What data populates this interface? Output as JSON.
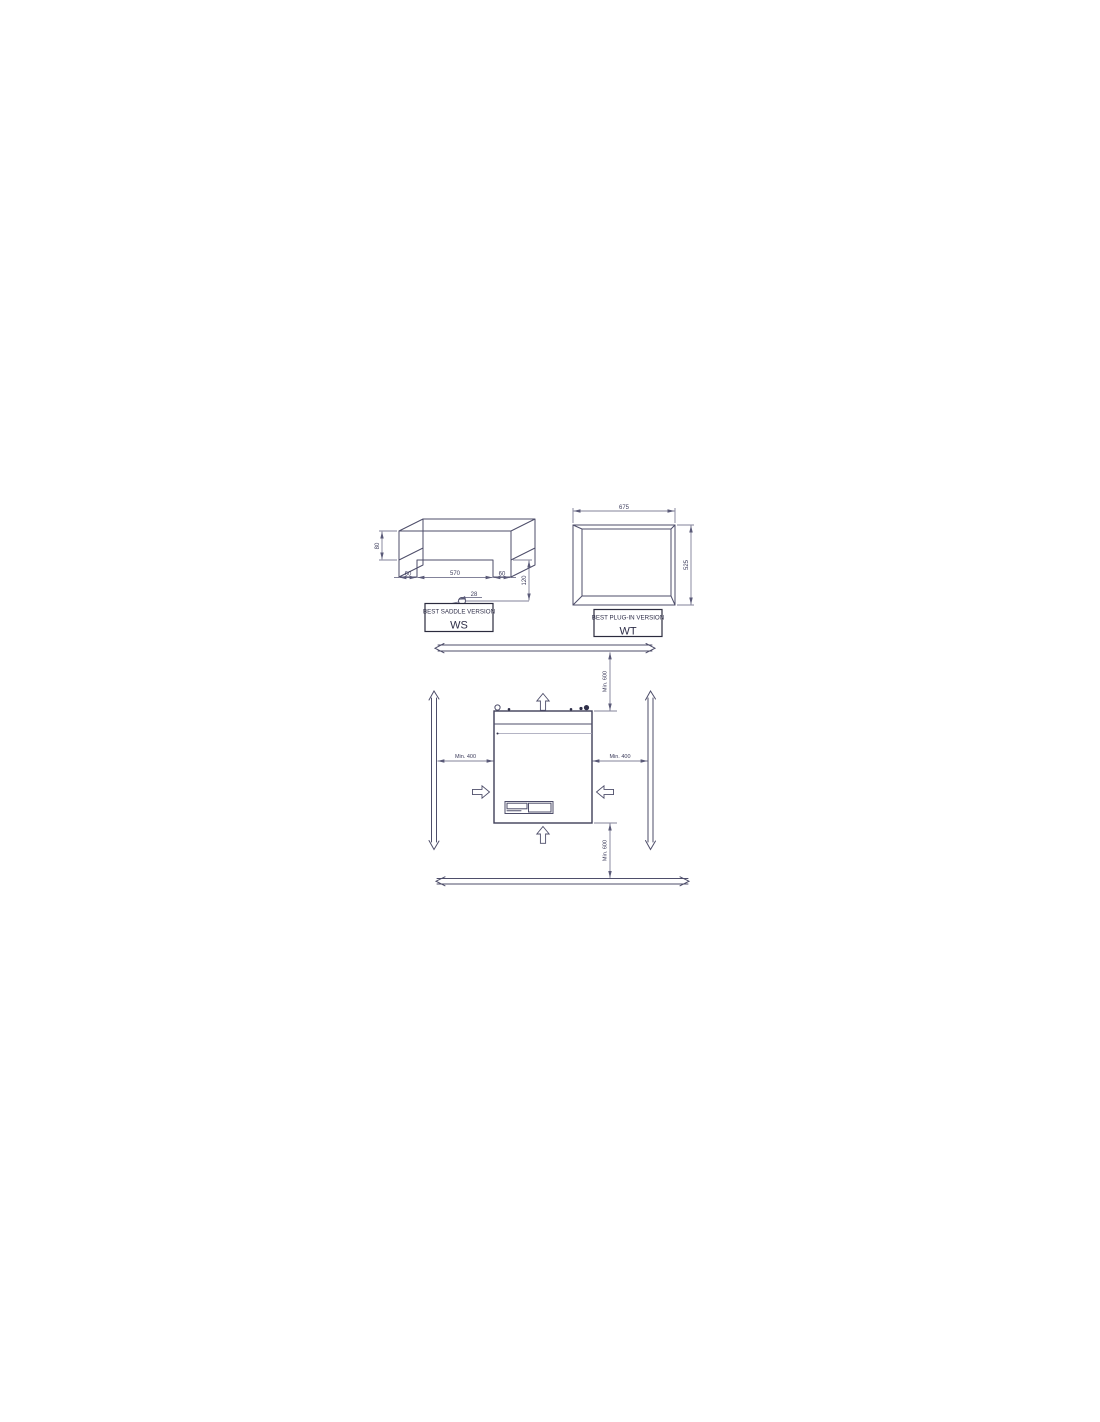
{
  "colors": {
    "background": "#ffffff",
    "outline": "#4e4e6a",
    "dimension_line": "#5a5a78",
    "light_line": "#9b9bb0",
    "text": "#3d3d5c",
    "box_border": "#2b2b3e"
  },
  "ws_drawing": {
    "title": "BEST SADDLE VERSION",
    "code": "WS",
    "dims": {
      "height": "80",
      "foot_left": "60",
      "span": "570",
      "foot_right": "60",
      "drop": "120",
      "hole": "28"
    }
  },
  "wt_drawing": {
    "title": "BEST PLUG-IN VERSION",
    "code": "WT",
    "dims": {
      "width": "675",
      "height": "525"
    }
  },
  "clearance": {
    "top": "Min. 600",
    "left": "Min. 400",
    "right": "Min. 400",
    "bottom": "Min. 600"
  }
}
